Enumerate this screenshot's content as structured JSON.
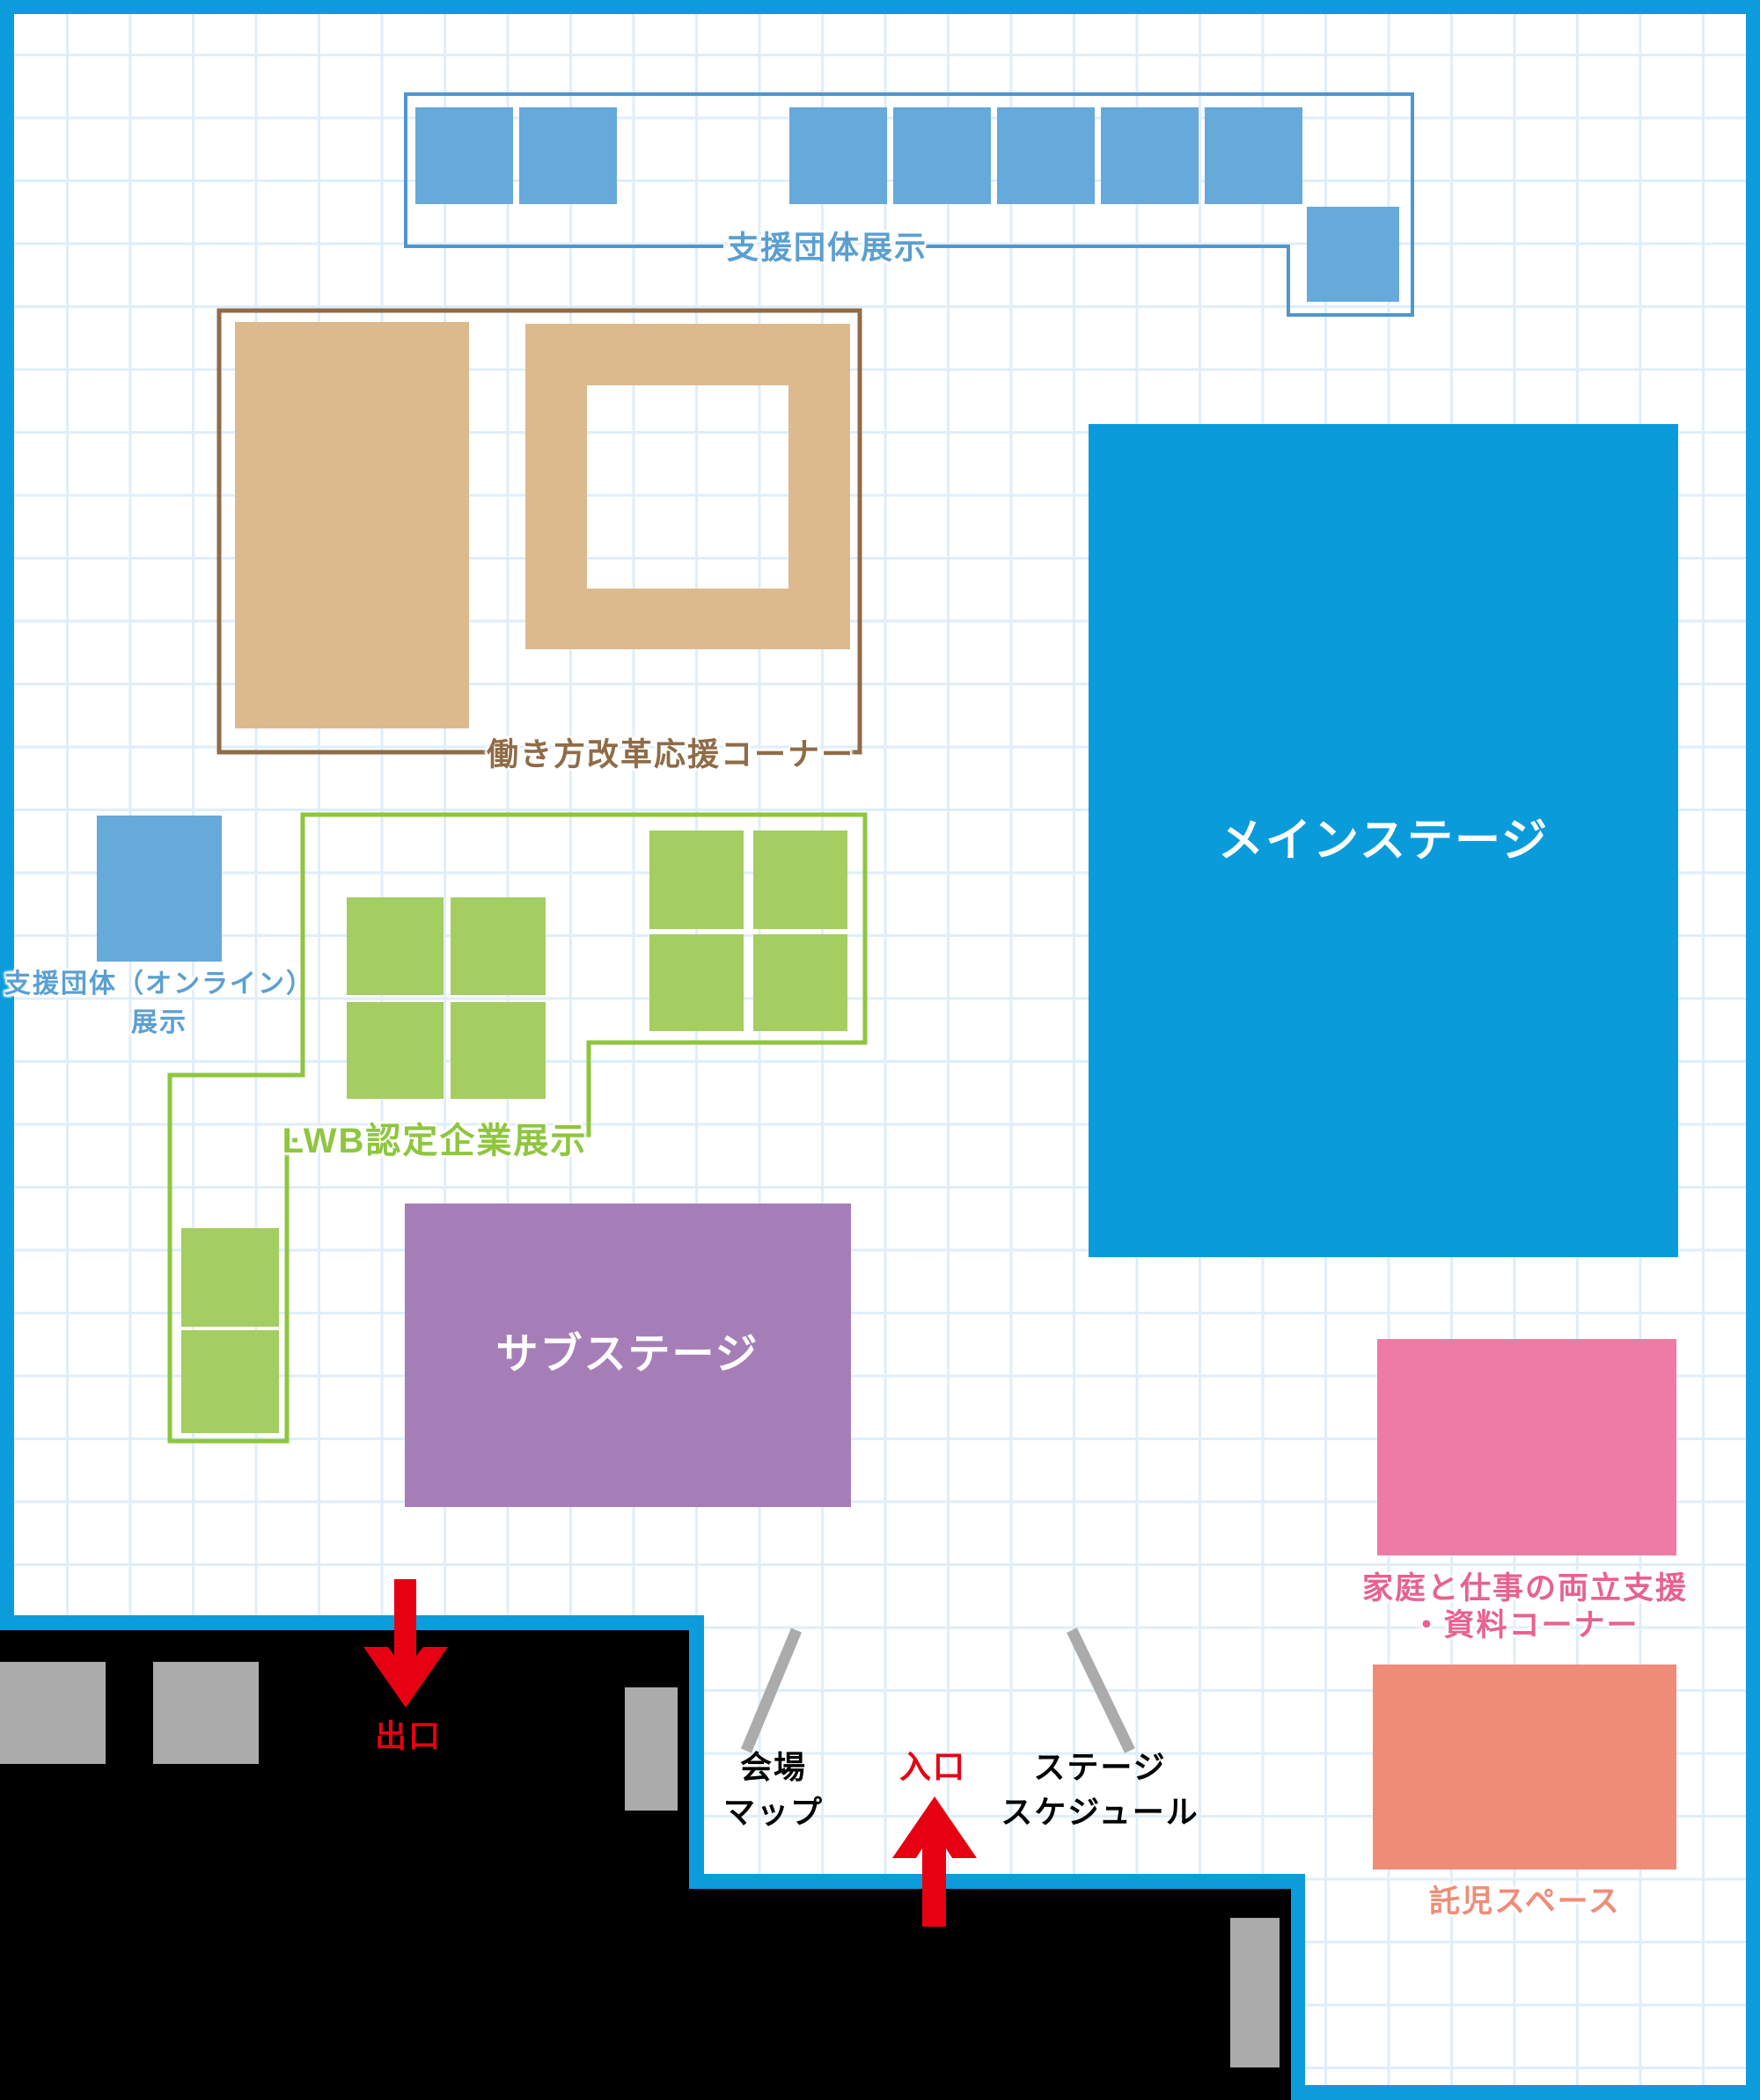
{
  "map": {
    "areas": {
      "support_groups": {
        "label": "支援団体展示",
        "booth_count": 8
      },
      "workstyle_reform": {
        "label": "働き方改革応援コーナー"
      },
      "support_online": {
        "line1": "支援団体（オンライン）",
        "line2": "展示",
        "booth_count": 1
      },
      "lwb": {
        "label": "LWB認定企業展示",
        "booth_count": 10
      },
      "main_stage": {
        "label": "メインステージ"
      },
      "sub_stage": {
        "label": "サブステージ"
      },
      "family_support": {
        "line1": "家庭と仕事の両立支援",
        "line2": "・資料コーナー"
      },
      "childcare": {
        "label": "託児スペース"
      }
    },
    "markers": {
      "exit": {
        "label": "出口"
      },
      "entrance": {
        "label": "入口"
      },
      "venue_map": {
        "line1": "会場",
        "line2": "マップ"
      },
      "stage_schedule": {
        "line1": "ステージ",
        "line2": "スケジュール"
      }
    },
    "colors": {
      "border_blue": "#0d9cdb",
      "stage_blue": "#0a9bdb",
      "grid_blue": "#dfeefa",
      "booth_blue": "#66a9db",
      "outline_blue": "#4f96cf",
      "label_blue": "#5b9fd2",
      "tan": "#dcba8e",
      "brown": "#8f6b47",
      "green_fill": "#a4cd62",
      "green_line": "#8ec63f",
      "purple": "#a67eb7",
      "pink": "#ee7ba3",
      "pink_text": "#e8618f",
      "salmon": "#ef8c78",
      "red": "#e60012",
      "gray": "#ababab",
      "black": "#000000"
    }
  }
}
